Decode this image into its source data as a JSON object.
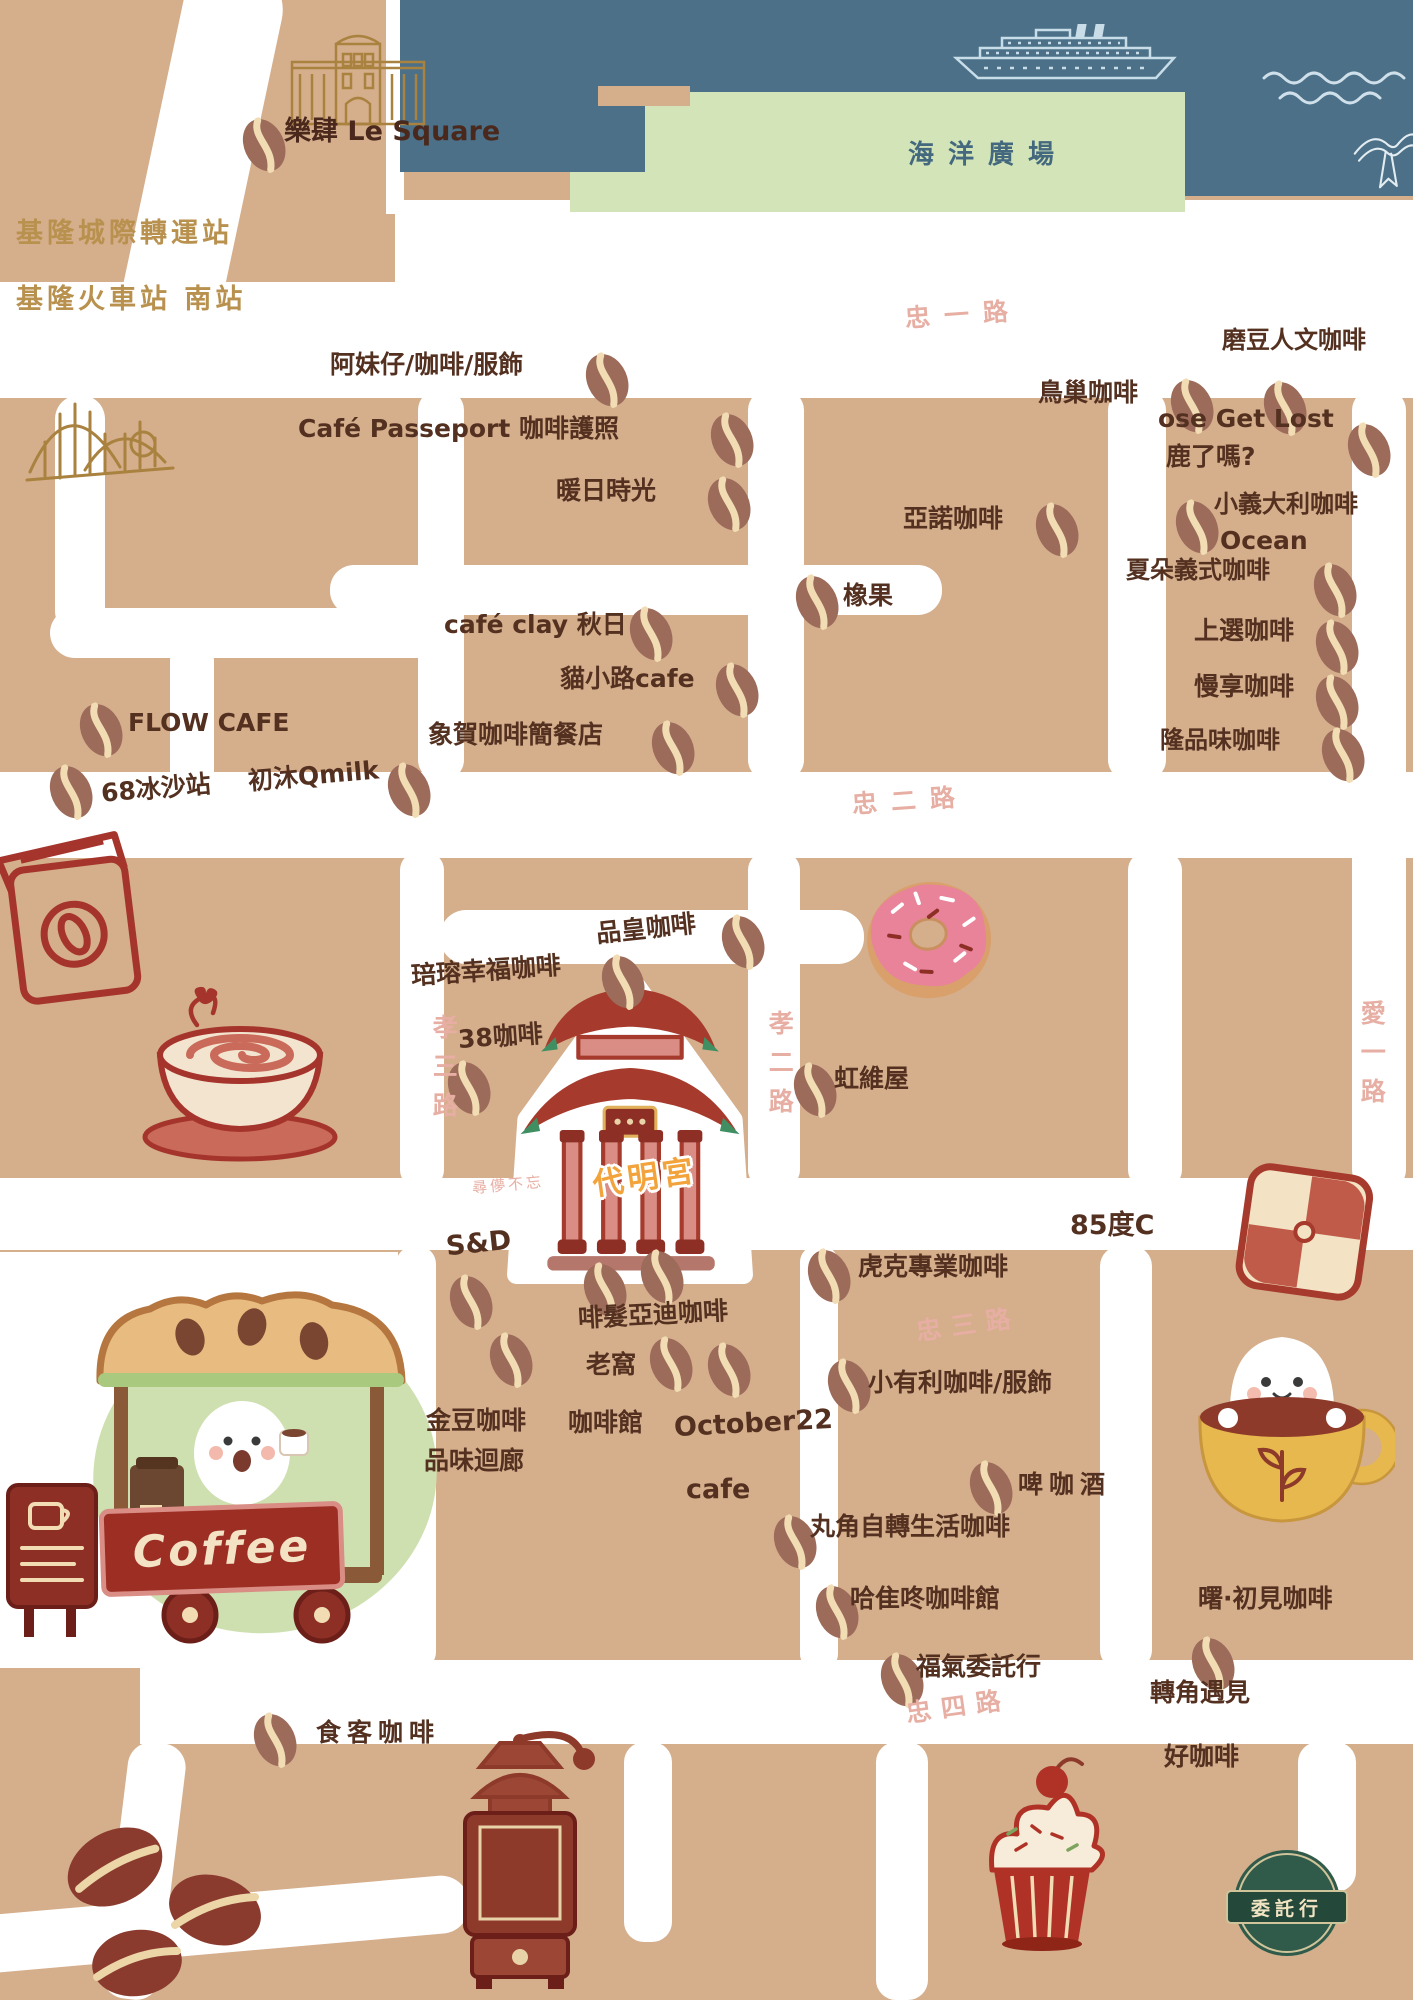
{
  "palette": {
    "land": "#d5ae8c",
    "street": "#ffffff",
    "harbor_blue": "#4b7088",
    "plaza_green": "#d3e5b8",
    "cafe_label_brown": "#53301f",
    "street_name_pink": "#e7aea3",
    "station_gold": "#b9914f",
    "illustration_red": "#a5352c",
    "temple_label_orange": "#f2a33c",
    "logo_green": "#305a49",
    "bean_body": "#9c6b5a",
    "bean_crease": "#f1dcb4"
  },
  "icons": {
    "cafe_marker": "coffee-bean-icon"
  },
  "harbor": {
    "plaza_label": "海洋廣場"
  },
  "temple": {
    "label": "代明宮",
    "note": "尋儚不忘"
  },
  "cart": {
    "sign_label": "Coffee"
  },
  "logo": {
    "banner_label": "委託行"
  },
  "landmarks": [
    {
      "text": "樂肆 Le Square",
      "x": 284,
      "y": 118
    }
  ],
  "stations": [
    {
      "text": "基隆城際轉運站",
      "x": 16,
      "y": 220
    },
    {
      "text": "基隆火車站 南站",
      "x": 16,
      "y": 286
    }
  ],
  "streets": [
    {
      "text": "忠一路",
      "x": 905,
      "y": 302,
      "ls": 14,
      "rot": -4
    },
    {
      "text": "忠二路",
      "x": 852,
      "y": 788,
      "ls": 14,
      "rot": -4
    },
    {
      "text": "忠三路",
      "x": 916,
      "y": 1312,
      "ls": 10,
      "rot": -8
    },
    {
      "text": "忠四路",
      "x": 906,
      "y": 1694,
      "ls": 10,
      "rot": -8
    },
    {
      "text": "孝三路",
      "x": 430,
      "y": 1014,
      "v": true,
      "ls": 14
    },
    {
      "text": "孝二路",
      "x": 766,
      "y": 1010,
      "v": true,
      "ls": 14
    },
    {
      "text": "愛一路",
      "x": 1358,
      "y": 1000,
      "v": true,
      "ls": 14
    }
  ],
  "cafes": [
    {
      "text": "阿妹仔/咖啡/服飾",
      "x": 330,
      "y": 352
    },
    {
      "text": "Café Passeport 咖啡護照",
      "x": 298,
      "y": 416
    },
    {
      "text": "暖日時光",
      "x": 556,
      "y": 478
    },
    {
      "text": "鳥巢咖啡",
      "x": 1038,
      "y": 380
    },
    {
      "text": "磨豆人文咖啡",
      "x": 1222,
      "y": 328,
      "s": 24
    },
    {
      "text": "ose Get Lost",
      "x": 1158,
      "y": 406
    },
    {
      "text": "鹿了嗎?",
      "x": 1166,
      "y": 444
    },
    {
      "text": "小義大利咖啡",
      "x": 1214,
      "y": 492,
      "s": 24
    },
    {
      "text": "Ocean",
      "x": 1220,
      "y": 528
    },
    {
      "text": "亞諾咖啡",
      "x": 903,
      "y": 506
    },
    {
      "text": "橡果",
      "x": 843,
      "y": 583
    },
    {
      "text": "夏朵義式咖啡",
      "x": 1126,
      "y": 558,
      "s": 24
    },
    {
      "text": "上選咖啡",
      "x": 1194,
      "y": 618
    },
    {
      "text": "慢享咖啡",
      "x": 1194,
      "y": 674
    },
    {
      "text": "隆品味咖啡",
      "x": 1160,
      "y": 728,
      "s": 24
    },
    {
      "text": "café clay 秋日",
      "x": 444,
      "y": 612
    },
    {
      "text": "貓小路cafe",
      "x": 560,
      "y": 666
    },
    {
      "text": "象賀咖啡簡餐店",
      "x": 428,
      "y": 722
    },
    {
      "text": "FLOW CAFE",
      "x": 128,
      "y": 710
    },
    {
      "text": "68冰沙站",
      "x": 101,
      "y": 776,
      "rot": -5
    },
    {
      "text": "初沐Qmilk",
      "x": 248,
      "y": 763,
      "rot": -5
    },
    {
      "text": "品皇咖啡",
      "x": 596,
      "y": 916,
      "rot": -6
    },
    {
      "text": "琣瑢幸福咖啡",
      "x": 411,
      "y": 958,
      "rot": -4
    },
    {
      "text": "38咖啡",
      "x": 458,
      "y": 1024,
      "rot": -4
    },
    {
      "text": "虹維屋",
      "x": 834,
      "y": 1066
    },
    {
      "text": "S&D",
      "x": 446,
      "y": 1230,
      "s": 27,
      "rot": -6
    },
    {
      "text": "85度C",
      "x": 1070,
      "y": 1212,
      "s": 27
    },
    {
      "text": "虎克專業咖啡",
      "x": 858,
      "y": 1254
    },
    {
      "text": "啡髮亞迪咖啡",
      "x": 578,
      "y": 1302,
      "rot": -3
    },
    {
      "text": "老窩",
      "x": 586,
      "y": 1352
    },
    {
      "text": "咖啡館",
      "x": 568,
      "y": 1410
    },
    {
      "text": "October22",
      "x": 674,
      "y": 1410,
      "s": 27,
      "rot": -3
    },
    {
      "text": "cafe",
      "x": 686,
      "y": 1476,
      "s": 27
    },
    {
      "text": "金豆咖啡",
      "x": 426,
      "y": 1408
    },
    {
      "text": "品味迴廊",
      "x": 424,
      "y": 1448
    },
    {
      "text": "小有利咖啡/服飾",
      "x": 868,
      "y": 1370
    },
    {
      "text": "啤咖酒",
      "x": 1018,
      "y": 1472,
      "ls": 6
    },
    {
      "text": "丸角自轉生活咖啡",
      "x": 810,
      "y": 1514
    },
    {
      "text": "哈隹咚咖啡館",
      "x": 850,
      "y": 1586
    },
    {
      "text": "福氣委託行",
      "x": 916,
      "y": 1654
    },
    {
      "text": "曙·初見咖啡",
      "x": 1198,
      "y": 1586
    },
    {
      "text": "轉角遇見",
      "x": 1150,
      "y": 1680
    },
    {
      "text": "好咖啡",
      "x": 1164,
      "y": 1744
    },
    {
      "text": "食客咖啡",
      "x": 316,
      "y": 1720,
      "ls": 6
    }
  ],
  "beans": [
    {
      "x": 265,
      "y": 147
    },
    {
      "x": 608,
      "y": 382
    },
    {
      "x": 733,
      "y": 442
    },
    {
      "x": 730,
      "y": 506
    },
    {
      "x": 1193,
      "y": 408
    },
    {
      "x": 1286,
      "y": 410
    },
    {
      "x": 1370,
      "y": 452
    },
    {
      "x": 1198,
      "y": 529
    },
    {
      "x": 1058,
      "y": 532
    },
    {
      "x": 818,
      "y": 604
    },
    {
      "x": 1336,
      "y": 592
    },
    {
      "x": 1338,
      "y": 649
    },
    {
      "x": 1338,
      "y": 704
    },
    {
      "x": 1344,
      "y": 757
    },
    {
      "x": 652,
      "y": 636
    },
    {
      "x": 738,
      "y": 692
    },
    {
      "x": 674,
      "y": 750
    },
    {
      "x": 102,
      "y": 732
    },
    {
      "x": 72,
      "y": 794
    },
    {
      "x": 410,
      "y": 792
    },
    {
      "x": 744,
      "y": 944
    },
    {
      "x": 624,
      "y": 984
    },
    {
      "x": 470,
      "y": 1090
    },
    {
      "x": 816,
      "y": 1092
    },
    {
      "x": 472,
      "y": 1304
    },
    {
      "x": 606,
      "y": 1292
    },
    {
      "x": 663,
      "y": 1279
    },
    {
      "x": 830,
      "y": 1278
    },
    {
      "x": 512,
      "y": 1362
    },
    {
      "x": 672,
      "y": 1366
    },
    {
      "x": 730,
      "y": 1372
    },
    {
      "x": 850,
      "y": 1388
    },
    {
      "x": 992,
      "y": 1490
    },
    {
      "x": 796,
      "y": 1544
    },
    {
      "x": 838,
      "y": 1614
    },
    {
      "x": 903,
      "y": 1682
    },
    {
      "x": 1214,
      "y": 1666
    },
    {
      "x": 276,
      "y": 1742
    }
  ]
}
